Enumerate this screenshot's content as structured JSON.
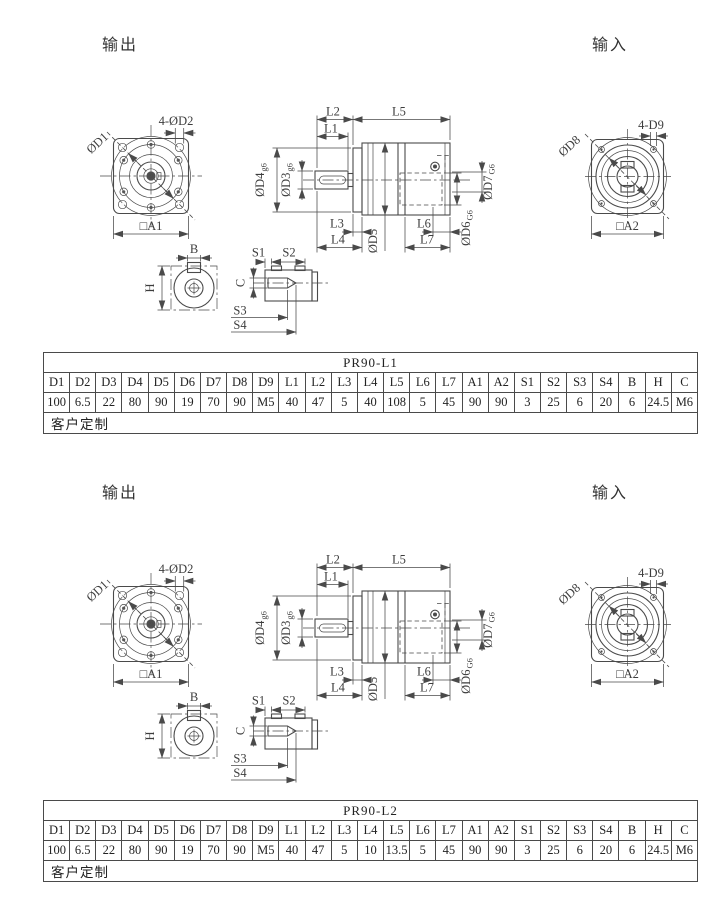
{
  "colors": {
    "line": "#4a4a4a",
    "text": "#3d3d3d",
    "background": "#ffffff"
  },
  "labels": {
    "output": "输出",
    "input": "输入",
    "front_view": {
      "holes": "4-ØD2",
      "bolt_circle": "ØD1",
      "square": "□A1"
    },
    "side_view": {
      "l1": "L1",
      "l2": "L2",
      "l3": "L3",
      "l4": "L4",
      "l5": "L5",
      "l6": "L6",
      "l7": "L7",
      "d3": "ØD3",
      "d3_tol": "g6",
      "d4": "ØD4",
      "d4_tol": "g6",
      "d5": "ØD5",
      "d6": "ØD6",
      "d6_tol": "G6",
      "d7": "ØD7",
      "d7_tol": "G6"
    },
    "rear_view": {
      "holes": "4-D9",
      "bolt_circle": "ØD8",
      "square": "□A2"
    },
    "shaft_detail": {
      "width": "B",
      "height": "H"
    },
    "keyway_detail": {
      "s1": "S1",
      "s2": "S2",
      "s3": "S3",
      "s4": "S4",
      "c": "C"
    }
  },
  "sections": [
    {
      "table": {
        "title": "PR90-L1",
        "headers": [
          "D1",
          "D2",
          "D3",
          "D4",
          "D5",
          "D6",
          "D7",
          "D8",
          "D9",
          "L1",
          "L2",
          "L3",
          "L4",
          "L5",
          "L6",
          "L7",
          "A1",
          "A2",
          "S1",
          "S2",
          "S3",
          "S4",
          "B",
          "H",
          "C"
        ],
        "values": [
          "100",
          "6.5",
          "22",
          "80",
          "90",
          "19",
          "70",
          "90",
          "M5",
          "40",
          "47",
          "5",
          "40",
          "108",
          "5",
          "45",
          "90",
          "90",
          "3",
          "25",
          "6",
          "20",
          "6",
          "24.5",
          "M6"
        ],
        "footer": "客户定制"
      }
    },
    {
      "table": {
        "title": "PR90-L2",
        "headers": [
          "D1",
          "D2",
          "D3",
          "D4",
          "D5",
          "D6",
          "D7",
          "D8",
          "D9",
          "L1",
          "L2",
          "L3",
          "L4",
          "L5",
          "L6",
          "L7",
          "A1",
          "A2",
          "S1",
          "S2",
          "S3",
          "S4",
          "B",
          "H",
          "C"
        ],
        "values": [
          "100",
          "6.5",
          "22",
          "80",
          "90",
          "19",
          "70",
          "90",
          "M5",
          "40",
          "47",
          "5",
          "10",
          "13.5",
          "5",
          "45",
          "90",
          "90",
          "3",
          "25",
          "6",
          "20",
          "6",
          "24.5",
          "M6"
        ],
        "footer": "客户定制"
      }
    }
  ]
}
